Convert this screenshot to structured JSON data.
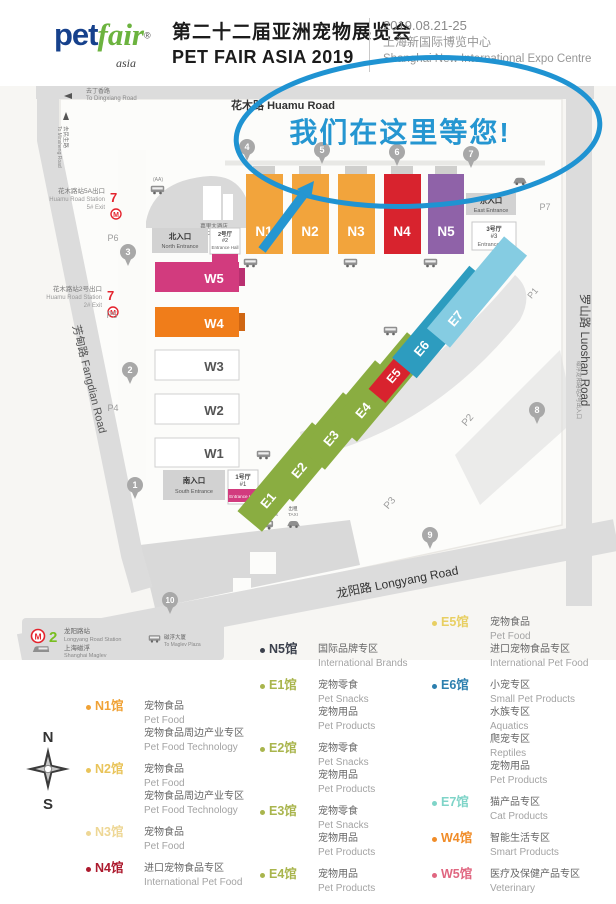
{
  "header": {
    "logo_pet": "pet",
    "logo_fair": "fair",
    "logo_reg": "®",
    "logo_asia": "asia",
    "title_cn": "第二十二届亚洲宠物展览会",
    "title_en": "PET FAIR ASIA 2019",
    "date": "2019.08.21-25",
    "venue_cn": "上海新国际博览中心",
    "venue_en": "Shanghai New International Expo Centre"
  },
  "map": {
    "banner": "我们在这里等您!",
    "metro_m": "M",
    "colors": {
      "accent_blue": "#2596d1",
      "n_orange": "#f2a43c",
      "n4_red": "#d8232e",
      "n5_purple": "#8f62a8",
      "w5_pink": "#d23b7e",
      "w4_orange": "#f07d1a",
      "e_green": "#8aad41",
      "e5_red": "#d8232e",
      "e5_orange": "#f2a43c",
      "e6_blue": "#2d9cbf",
      "e7_blue": "#85cce2",
      "line7_red": "#e4232d",
      "line2_green": "#78be20"
    },
    "roads": {
      "huamu": "花木路 Huamu Road",
      "luoshan": "罗山路 Luoshan Road",
      "longyang": "龙阳路 Longyang Road",
      "fangdian": "芳甸路 Fangdian Road",
      "to_dingxiang_cn": "去丁香路",
      "to_dingxiang_en": "To Dingxiang Road",
      "to_minsheng_cn": "去民生路",
      "to_minsheng_en": "To Minsheng Road",
      "maglev_exit": "磁浮龙阳路站2号出入口"
    },
    "entrances": {
      "north_cn": "北入口",
      "north_en": "North Entrance",
      "east_cn": "东入口",
      "east_en": "East Entrance",
      "south_cn": "南入口",
      "south_en": "South Entrance"
    },
    "entrance_halls": {
      "h1_cn": "1号厅",
      "h1_no": "#1",
      "h1_en": "Entrance Hall",
      "h2_cn": "2号厅",
      "h2_no": "#2",
      "h2_en": "Entrance Hall",
      "h3_cn": "3号厅",
      "h3_no": "#3",
      "h3_en": "Entrance Hall"
    },
    "hotel": {
      "cn": "嘉里大酒店",
      "en": "Kerry Centre Hotel"
    },
    "metro7a": {
      "line": "7",
      "cn": "花木路站5A出口",
      "en": "Huamu Road Station",
      "exit": "5# Exit"
    },
    "metro7b": {
      "line": "7",
      "cn": "花木路站2号出口",
      "en": "Huamu Road Station",
      "exit": "2# Exit"
    },
    "metro2": {
      "line": "2",
      "cn": "龙阳路站",
      "en": "Longyang Road Station",
      "maglev_cn": "上海磁浮",
      "maglev_en": "Shanghai Maglev"
    },
    "to_plaza": {
      "cn": "磁浮大厦",
      "en": "To Maglev Plaza"
    },
    "shuttle": {
      "cn": "班车",
      "en": "Shuttle Bus"
    },
    "taxi": {
      "cn": "出租",
      "en": "TAXI"
    },
    "parking_note": "(AA)",
    "halls": {
      "n1": "N1",
      "n2": "N2",
      "n3": "N3",
      "n4": "N4",
      "n5": "N5",
      "w1": "W1",
      "w2": "W2",
      "w3": "W3",
      "w4": "W4",
      "w5": "W5",
      "e1": "E1",
      "e2": "E2",
      "e3": "E3",
      "e4": "E4",
      "e5": "E5",
      "e6": "E6",
      "e7": "E7"
    },
    "parking": {
      "p1": "P1",
      "p2": "P2",
      "p3": "P3",
      "p4": "P4",
      "p5": "P5",
      "p6": "P6",
      "p7": "P7"
    },
    "gates": {
      "g1": "1",
      "g2": "2",
      "g3": "3",
      "g4": "4",
      "g5": "5",
      "g6": "6",
      "g7": "7",
      "g8": "8",
      "g9": "9",
      "g10": "10"
    }
  },
  "compass": {
    "n": "N",
    "s": "S"
  },
  "legend": {
    "col1": [
      {
        "id": "N1馆",
        "color": "#f0a236",
        "lines": [
          [
            "宠物食品",
            "Pet Food"
          ],
          [
            "宠物食品周边产业专区",
            "Pet Food Technology"
          ]
        ]
      },
      {
        "id": "N2馆",
        "color": "#e9c45a",
        "lines": [
          [
            "宠物食品",
            "Pet Food"
          ],
          [
            "宠物食品周边产业专区",
            "Pet Food Technology"
          ]
        ]
      },
      {
        "id": "N3馆",
        "color": "#eed795",
        "lines": [
          [
            "宠物食品",
            "Pet Food"
          ]
        ]
      },
      {
        "id": "N4馆",
        "color": "#ad1a2e",
        "lines": [
          [
            "进口宠物食品专区",
            "International Pet Food"
          ]
        ]
      }
    ],
    "col2": [
      {
        "id": "N5馆",
        "color": "#3c414d",
        "lines": [
          [
            "国际品牌专区",
            "International Brands"
          ]
        ]
      },
      {
        "id": "E1馆",
        "color": "#a9b54d",
        "lines": [
          [
            "宠物零食",
            "Pet Snacks"
          ],
          [
            "宠物用品",
            "Pet Products"
          ]
        ]
      },
      {
        "id": "E2馆",
        "color": "#a9b54d",
        "lines": [
          [
            "宠物零食",
            "Pet Snacks"
          ],
          [
            "宠物用品",
            "Pet Products"
          ]
        ]
      },
      {
        "id": "E3馆",
        "color": "#a9b54d",
        "lines": [
          [
            "宠物零食",
            "Pet Snacks"
          ],
          [
            "宠物用品",
            "Pet Products"
          ]
        ]
      },
      {
        "id": "E4馆",
        "color": "#a9b54d",
        "lines": [
          [
            "宠物用品",
            "Pet Products"
          ]
        ]
      }
    ],
    "col3": [
      {
        "id": "E5馆",
        "color": "#e8cf62",
        "lines": [
          [
            "宠物食品",
            "Pet Food"
          ],
          [
            "进口宠物食品专区",
            "International Pet Food"
          ]
        ]
      },
      {
        "id": "E6馆",
        "color": "#2c7fae",
        "lines": [
          [
            "小宠专区",
            "Small Pet Products"
          ],
          [
            "水族专区",
            "Aquatics"
          ],
          [
            "爬宠专区",
            "Reptiles"
          ],
          [
            "宠物用品",
            "Pet Products"
          ]
        ]
      },
      {
        "id": "E7馆",
        "color": "#7fd4c8",
        "lines": [
          [
            "猫产品专区",
            "Cat Products"
          ]
        ]
      },
      {
        "id": "W4馆",
        "color": "#f08c28",
        "lines": [
          [
            "智能生活专区",
            "Smart Products"
          ]
        ]
      },
      {
        "id": "W5馆",
        "color": "#e06680",
        "lines": [
          [
            "医疗及保健产品专区",
            "Veterinary"
          ]
        ]
      }
    ]
  }
}
